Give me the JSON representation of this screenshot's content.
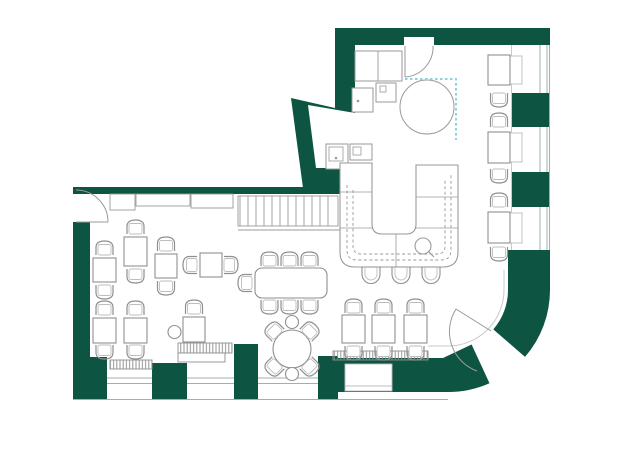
{
  "document": {
    "type": "floor-plan",
    "subject": "restaurant cafe floor plan, top-down architectural drawing",
    "orientation": "L-shaped space, kitchen and bar upper right, dining lower left, curved entrance lower right"
  },
  "colors": {
    "wall": "#0d5443",
    "floor": "#ffffff",
    "background": "#ffffff",
    "furniture_line": "#8f8f8f",
    "light_line": "#bdbdbd",
    "window_line": "#9fb0ae",
    "screen_dash": "#8ed2da",
    "hatch_line": "#8a8a8a"
  },
  "areas": {
    "dining": "main dining area",
    "bar": "U-shaped bar counter with sink",
    "kitchen": "kitchen with sink and counters",
    "entrance": "curved entrance wall with door",
    "stairs": "straight stair run, 13 treads"
  },
  "inventory": {
    "small_tables": 10,
    "wall_tables": 3,
    "communal_table": 1,
    "round_table": 1,
    "chairs": 35,
    "bar_stools": 3,
    "round_stools": 3,
    "benches": 4,
    "doors": 3,
    "window_bays": 7,
    "large_circle_feature": 1,
    "dashed_screen": 1
  }
}
